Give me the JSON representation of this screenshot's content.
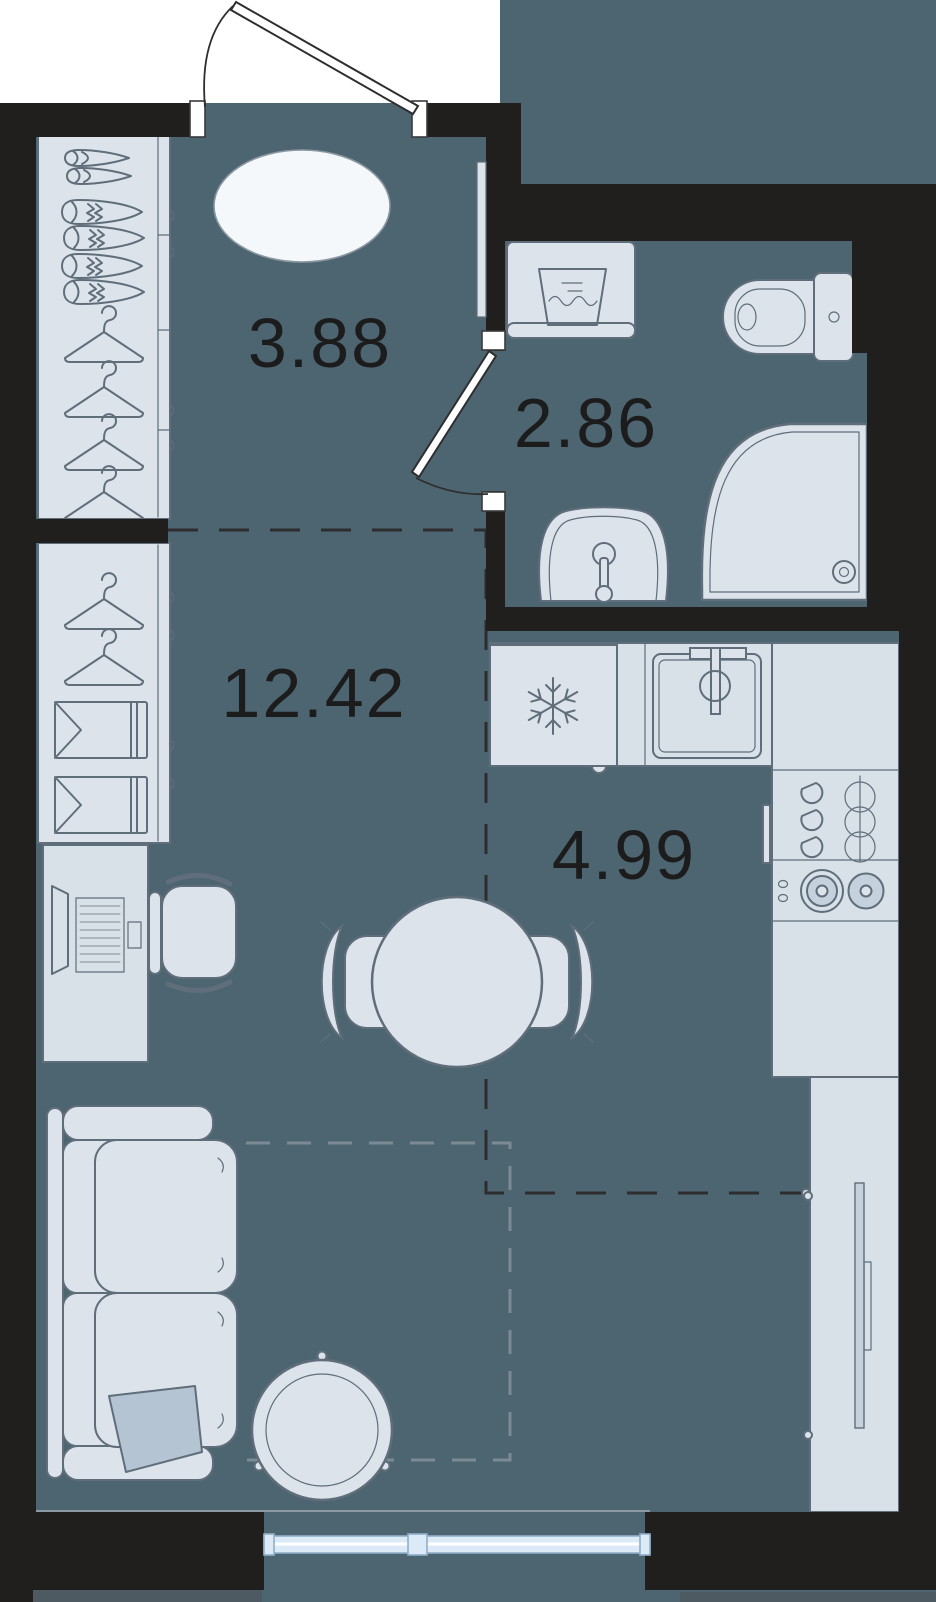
{
  "plan_type": "studio-apartment-floor-plan",
  "rooms": {
    "hall": {
      "name": "entry-hall",
      "area": "3.88"
    },
    "bathroom": {
      "name": "bathroom",
      "area": "2.86"
    },
    "living": {
      "name": "living-room",
      "area": "12.42"
    },
    "kitchen": {
      "name": "kitchen",
      "area": "4.99"
    }
  },
  "furniture_icons": [
    "entrance-door",
    "door-swing-arc",
    "shoe-rack",
    "hanger-icon",
    "oval-rug",
    "closet-shirts",
    "desk-laptop",
    "office-chair",
    "dining-table",
    "dining-chair",
    "sofa",
    "pillow",
    "coffee-table",
    "washing-machine",
    "toilet",
    "shower-cabin",
    "bathroom-sink",
    "bathroom-door",
    "mirror",
    "fridge",
    "snowflake-icon",
    "kitchen-sink",
    "faucet-icon",
    "dish-rack",
    "stove-burners",
    "kitchen-counter",
    "tv-cabinet",
    "tv",
    "window"
  ],
  "colors": {
    "floor": "#4d6570",
    "exterior": "#ffffff",
    "wall": "#201f1e",
    "furniture_fill": "#dce3eb",
    "furniture_dark": "#c5d1dd",
    "counter": "#d8e0e8",
    "furniture_stroke": "#5f6e7a",
    "rug": "#f5f8fa",
    "pillow": "#b4c4d3",
    "window": "#dceaf7",
    "window_frame": "#8fafc9",
    "label": "#1c1c1c",
    "dash_dark": "#2d2d2d",
    "dash_light": "#7b8a94",
    "plinth": "#4e5a61"
  }
}
